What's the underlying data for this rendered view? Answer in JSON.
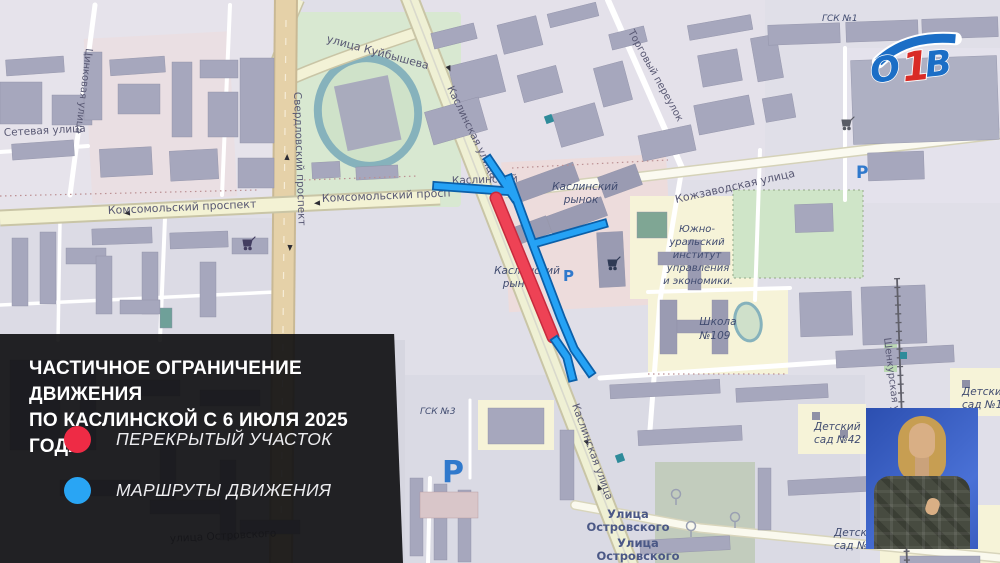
{
  "channel": {
    "name": "ОТВ",
    "logo": {
      "o": "О",
      "one": "1",
      "v": "В"
    },
    "logo_blue": "#1b6ec6",
    "logo_red": "#d92b26"
  },
  "banner": {
    "title1": "ЧАСТИЧНОЕ ОГРАНИЧЕНИЕ ДВИЖЕНИЯ",
    "title2": "ПО КАСЛИНСКОЙ С 6 ИЮЛЯ 2025 ГОДА",
    "legend": [
      {
        "color": "#ee2b45",
        "label": "ПЕРЕКРЫТЫЙ УЧАСТОК"
      },
      {
        "color": "#29a5f4",
        "label": "МАРШРУТЫ ДВИЖЕНИЯ"
      }
    ],
    "panel_bg": "rgba(13,13,16,0.9)"
  },
  "map": {
    "route_colors": {
      "closed_section": "#ea4052",
      "detour_route": "#25a2f5"
    },
    "streets": {
      "setevaya": "Сетевая улица",
      "tsinkovaya": "Цинковая улица",
      "kuybysheva": "улица Куйбышева",
      "sverdlovsky": "Свердловский проспект",
      "komsomolsky": "Комсомольский проспект",
      "komsomolsky_short": "Комсомольский просп",
      "kaslinskaya": "Каслинская улица",
      "kaslinsky_part": "Каслинский",
      "kozhzavodskaya": "Кожзаводская улица",
      "torgovy": "Торговый переулок",
      "shenkurskaya": "Шенкурская ул",
      "ostrovskogo_lower": "улица Островского",
      "ostrovskogo_line1": "Улица",
      "ostrovskogo_line2": "Островского"
    },
    "pois": {
      "market_line1": "Каслинский",
      "market_line2": "рынок",
      "institute": [
        "Южно-",
        "уральский",
        "институт",
        "управления",
        "и экономики."
      ],
      "school_line1": "Школа",
      "school_line2": "№109",
      "gsk3": "ГСК №3",
      "gsk1": "ГСК №1",
      "kinder_line1": "Детский",
      "kinder42_line2": "сад №42",
      "kinder1_line2": "сад №1",
      "kinder10_line2": "сад №10",
      "parking": "Р"
    }
  }
}
